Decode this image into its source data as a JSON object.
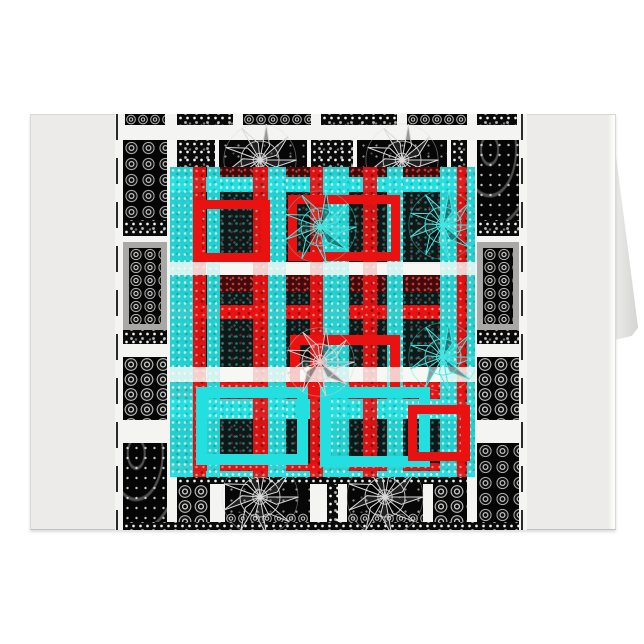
{
  "meta": {
    "description": "Product mockup photo of a folded greeting card standing on a white background. The card front shows an abstract black-and-white ornamental grid pattern overlaid with a turquoise and red plaid motif. No text is visible.",
    "alt_label": "greeting-card-product-photo"
  },
  "palette": {
    "page": "#ffffff",
    "card": "#ecebe9",
    "card_edge": "#d9d8d6",
    "wedge_from": "#eeeeec",
    "wedge_to": "#d2d2d0",
    "design_bg": "#f4f4f2",
    "dash": "#2a2a2a",
    "grayframe": "#a9a8a6",
    "cyan": "#23dfdf",
    "red": "#ea1111",
    "darkred": "#3f0b0b",
    "darkcell": "#0c1918",
    "medallion_silver": "#d8d8d8",
    "medallion_cyan": "#45e6e2",
    "medallion_pink": "#e8c8c8"
  },
  "card": {
    "x": 30,
    "y": 114,
    "w": 586,
    "h": 416
  },
  "wedge": {
    "x": 612,
    "y": 136,
    "w": 28,
    "h": 206,
    "points": [
      [
        7,
        2
      ],
      [
        93,
        93
      ],
      [
        71,
        97
      ],
      [
        11,
        99
      ]
    ]
  },
  "highlight": {
    "x": 608,
    "y": 115,
    "w": 7,
    "h": 414
  },
  "design": {
    "x": 115,
    "y": 114,
    "w": 412,
    "h": 416
  },
  "dashes": [
    {
      "x": 1
    },
    {
      "x": 406
    }
  ],
  "blocks": [
    {
      "x": 10,
      "y": 0,
      "w": 40,
      "h": 11,
      "t": "circles-sm"
    },
    {
      "x": 62,
      "y": 0,
      "w": 56,
      "h": 11,
      "t": "speckle"
    },
    {
      "x": 128,
      "y": 0,
      "w": 68,
      "h": 11,
      "t": "circles-sm"
    },
    {
      "x": 206,
      "y": 0,
      "w": 76,
      "h": 11,
      "t": "speckle"
    },
    {
      "x": 292,
      "y": 0,
      "w": 60,
      "h": 11,
      "t": "circles-sm"
    },
    {
      "x": 362,
      "y": 0,
      "w": 40,
      "h": 11,
      "t": "speckle"
    },
    {
      "x": 8,
      "y": 26,
      "w": 44,
      "h": 80,
      "t": "ornate"
    },
    {
      "x": 62,
      "y": 26,
      "w": 38,
      "h": 124,
      "t": "speckle"
    },
    {
      "x": 104,
      "y": 26,
      "w": 88,
      "h": 124,
      "t": "plain"
    },
    {
      "x": 196,
      "y": 26,
      "w": 42,
      "h": 124,
      "t": "speckle"
    },
    {
      "x": 242,
      "y": 26,
      "w": 90,
      "h": 124,
      "t": "plain"
    },
    {
      "x": 336,
      "y": 26,
      "w": 16,
      "h": 124,
      "t": "speckle"
    },
    {
      "x": 362,
      "y": 26,
      "w": 42,
      "h": 80,
      "t": "paisley"
    },
    {
      "x": 8,
      "y": 106,
      "w": 44,
      "h": 16,
      "t": "speckle"
    },
    {
      "x": 362,
      "y": 106,
      "w": 42,
      "h": 16,
      "t": "speckle"
    },
    {
      "x": 8,
      "y": 128,
      "w": 44,
      "h": 88,
      "t": "grayframe"
    },
    {
      "x": 362,
      "y": 128,
      "w": 42,
      "h": 88,
      "t": "grayframe"
    },
    {
      "x": 8,
      "y": 216,
      "w": 44,
      "h": 14,
      "t": "speckle"
    },
    {
      "x": 362,
      "y": 216,
      "w": 42,
      "h": 14,
      "t": "speckle"
    },
    {
      "x": 8,
      "y": 243,
      "w": 44,
      "h": 63,
      "t": "circles"
    },
    {
      "x": 362,
      "y": 243,
      "w": 42,
      "h": 63,
      "t": "circles"
    },
    {
      "x": 8,
      "y": 329,
      "w": 44,
      "h": 87,
      "t": "paisley"
    },
    {
      "x": 362,
      "y": 329,
      "w": 42,
      "h": 87,
      "t": "ornate"
    },
    {
      "x": 62,
      "y": 363,
      "w": 290,
      "h": 7,
      "t": "speckle"
    },
    {
      "x": 62,
      "y": 370,
      "w": 33,
      "h": 38,
      "t": "circles"
    },
    {
      "x": 110,
      "y": 370,
      "w": 85,
      "h": 38,
      "t": "plain"
    },
    {
      "x": 212,
      "y": 370,
      "w": 11,
      "h": 38,
      "t": "speckle"
    },
    {
      "x": 232,
      "y": 370,
      "w": 76,
      "h": 38,
      "t": "plain"
    },
    {
      "x": 318,
      "y": 370,
      "w": 34,
      "h": 38,
      "t": "circles"
    },
    {
      "x": 110,
      "y": 399,
      "w": 85,
      "h": 9,
      "t": "circles-sm"
    },
    {
      "x": 232,
      "y": 399,
      "w": 76,
      "h": 9,
      "t": "circles-sm"
    },
    {
      "x": 8,
      "y": 408,
      "w": 396,
      "h": 8,
      "t": "speckle"
    }
  ],
  "base_medallions": [
    {
      "cx": 145,
      "cy": 46,
      "r": 38,
      "color": "medallion_silver"
    },
    {
      "cx": 287,
      "cy": 46,
      "r": 38,
      "color": "medallion_silver"
    },
    {
      "cx": 145,
      "cy": 383,
      "r": 40,
      "color": "medallion_silver"
    },
    {
      "cx": 270,
      "cy": 383,
      "r": 40,
      "color": "medallion_silver"
    }
  ],
  "overlay": {
    "x": 55,
    "y": 53,
    "w": 305,
    "h": 310,
    "h_bands": [
      {
        "y": 0,
        "h": 10,
        "c": "darkred"
      },
      {
        "y": 10,
        "h": 15,
        "c": "cyan"
      },
      {
        "y": 25,
        "h": 70,
        "c": "dark"
      },
      {
        "y": 95,
        "h": 13,
        "c": "white"
      },
      {
        "y": 108,
        "h": 17,
        "c": "darkred"
      },
      {
        "y": 125,
        "h": 13,
        "c": "dark"
      },
      {
        "y": 138,
        "h": 14,
        "c": "red"
      },
      {
        "y": 152,
        "h": 48,
        "c": "dark"
      },
      {
        "y": 200,
        "h": 15,
        "c": "white"
      },
      {
        "y": 215,
        "h": 17,
        "c": "red"
      },
      {
        "y": 232,
        "h": 20,
        "c": "cyan"
      },
      {
        "y": 252,
        "h": 44,
        "c": "dark"
      },
      {
        "y": 296,
        "h": 8,
        "c": "red"
      },
      {
        "y": 304,
        "h": 6,
        "c": "cyan"
      }
    ],
    "v_bands": [
      {
        "x": 0,
        "w": 23,
        "c": "cyan"
      },
      {
        "x": 23,
        "w": 13,
        "c": "red"
      },
      {
        "x": 37,
        "w": 13,
        "c": "cyan"
      },
      {
        "x": 83,
        "w": 15,
        "c": "red"
      },
      {
        "x": 98,
        "w": 18,
        "c": "cyan"
      },
      {
        "x": 140,
        "w": 13,
        "c": "red"
      },
      {
        "x": 153,
        "w": 26,
        "c": "cyan"
      },
      {
        "x": 193,
        "w": 14,
        "c": "red"
      },
      {
        "x": 217,
        "w": 16,
        "c": "cyan"
      },
      {
        "x": 270,
        "w": 17,
        "c": "cyan"
      },
      {
        "x": 287,
        "w": 10,
        "c": "red"
      },
      {
        "x": 297,
        "w": 9,
        "c": "cyan"
      }
    ],
    "crossers": [
      {
        "x": 0,
        "y": 95,
        "w": 305,
        "h": 13
      },
      {
        "x": 0,
        "y": 200,
        "w": 305,
        "h": 15
      }
    ],
    "frames": [
      {
        "x": 23,
        "y": 33,
        "w": 77,
        "h": 62,
        "b": 9,
        "c": "red"
      },
      {
        "x": 118,
        "y": 28,
        "w": 112,
        "h": 66,
        "b": 9,
        "c": "red"
      },
      {
        "x": 120,
        "y": 168,
        "w": 110,
        "h": 62,
        "b": 10,
        "c": "red"
      },
      {
        "x": 26,
        "y": 220,
        "w": 112,
        "h": 78,
        "b": 11,
        "c": "cyan"
      },
      {
        "x": 150,
        "y": 220,
        "w": 110,
        "h": 80,
        "b": 11,
        "c": "cyan"
      },
      {
        "x": 238,
        "y": 238,
        "w": 62,
        "h": 56,
        "b": 9,
        "c": "red"
      }
    ],
    "medallions": [
      {
        "cx": 150,
        "cy": 60,
        "r": 38,
        "color": "medallion_cyan"
      },
      {
        "cx": 273,
        "cy": 58,
        "r": 36,
        "color": "medallion_cyan"
      },
      {
        "cx": 150,
        "cy": 195,
        "r": 36,
        "color": "medallion_pink"
      },
      {
        "cx": 273,
        "cy": 190,
        "r": 36,
        "color": "medallion_cyan"
      }
    ]
  }
}
